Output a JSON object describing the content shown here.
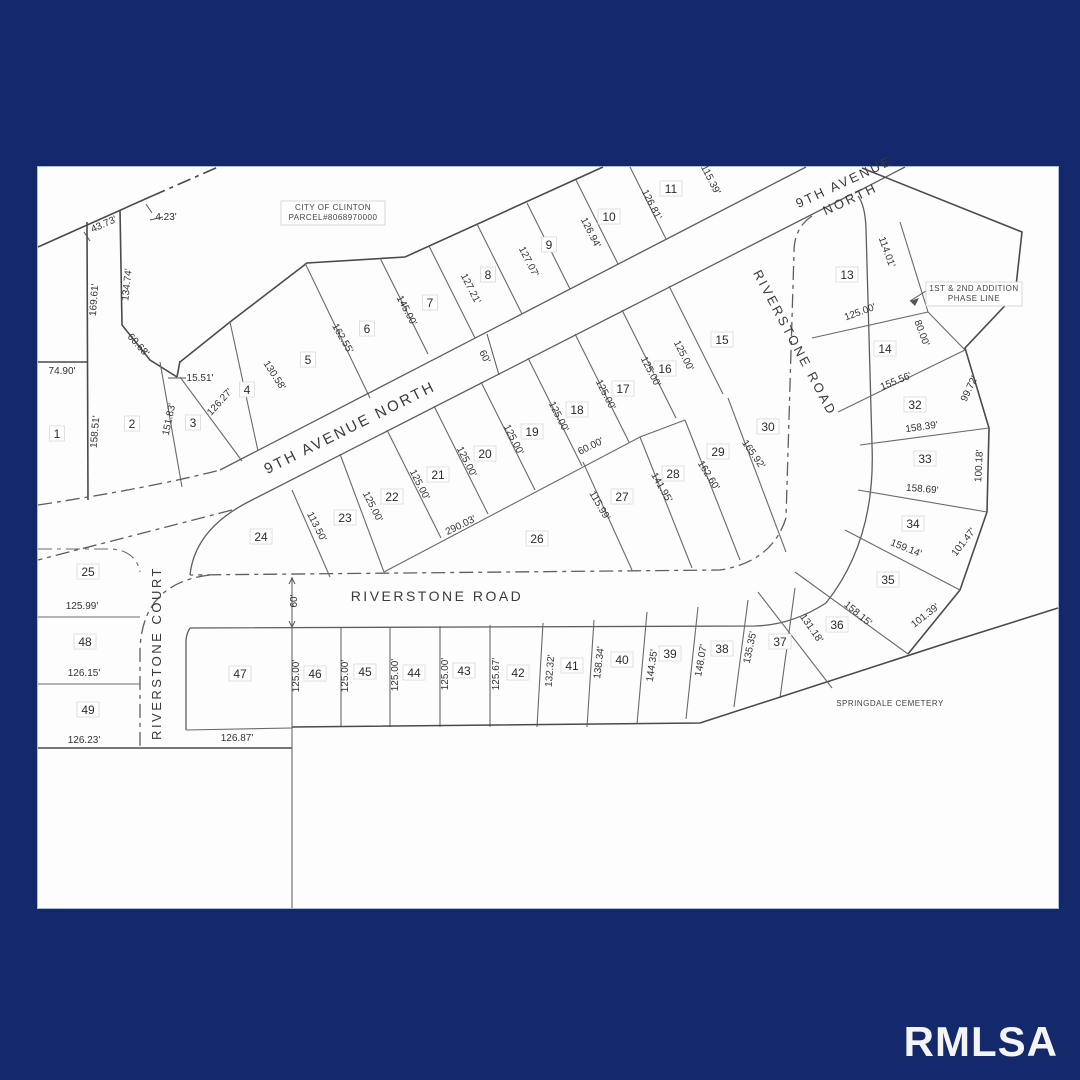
{
  "watermark": "RMLSA",
  "colors": {
    "border_background": "#13296b",
    "paper": "#fdfdfd",
    "line": "#5e5e5e",
    "text": "#2b2b2b"
  },
  "streets": [
    {
      "label": "9TH AVENUE NORTH",
      "x": 352,
      "y": 432,
      "rot": -26.5,
      "size": 15
    },
    {
      "label": "9TH AVENUE",
      "x": 846,
      "y": 186,
      "rot": -25,
      "size": 13
    },
    {
      "label": "NORTH",
      "x": 852,
      "y": 203,
      "rot": -25,
      "size": 13
    },
    {
      "label": "RIVERSTONE ROAD",
      "x": 791,
      "y": 345,
      "rot": 62,
      "size": 13
    },
    {
      "label": "RIVERSTONE ROAD",
      "x": 437,
      "y": 601,
      "rot": 0,
      "size": 14
    },
    {
      "label": "RIVERSTONE COURT",
      "x": 161,
      "y": 653,
      "rot": -90,
      "size": 13
    }
  ],
  "lots": [
    {
      "n": "1",
      "x": 57,
      "y": 437
    },
    {
      "n": "2",
      "x": 132,
      "y": 427
    },
    {
      "n": "3",
      "x": 193,
      "y": 426
    },
    {
      "n": "4",
      "x": 247,
      "y": 393
    },
    {
      "n": "5",
      "x": 308,
      "y": 363
    },
    {
      "n": "6",
      "x": 367,
      "y": 332
    },
    {
      "n": "7",
      "x": 430,
      "y": 306
    },
    {
      "n": "8",
      "x": 488,
      "y": 278
    },
    {
      "n": "9",
      "x": 549,
      "y": 248
    },
    {
      "n": "10",
      "x": 609,
      "y": 220
    },
    {
      "n": "11",
      "x": 671,
      "y": 192
    },
    {
      "n": "13",
      "x": 847,
      "y": 278
    },
    {
      "n": "14",
      "x": 885,
      "y": 352
    },
    {
      "n": "15",
      "x": 722,
      "y": 343
    },
    {
      "n": "16",
      "x": 665,
      "y": 372
    },
    {
      "n": "17",
      "x": 623,
      "y": 392
    },
    {
      "n": "18",
      "x": 577,
      "y": 413
    },
    {
      "n": "19",
      "x": 532,
      "y": 435
    },
    {
      "n": "20",
      "x": 485,
      "y": 457
    },
    {
      "n": "21",
      "x": 438,
      "y": 478
    },
    {
      "n": "22",
      "x": 392,
      "y": 500
    },
    {
      "n": "23",
      "x": 345,
      "y": 521
    },
    {
      "n": "24",
      "x": 261,
      "y": 540
    },
    {
      "n": "25",
      "x": 88,
      "y": 575
    },
    {
      "n": "26",
      "x": 537,
      "y": 542
    },
    {
      "n": "27",
      "x": 622,
      "y": 500
    },
    {
      "n": "28",
      "x": 673,
      "y": 477
    },
    {
      "n": "29",
      "x": 718,
      "y": 455
    },
    {
      "n": "30",
      "x": 768,
      "y": 430
    },
    {
      "n": "32",
      "x": 915,
      "y": 408
    },
    {
      "n": "33",
      "x": 925,
      "y": 462
    },
    {
      "n": "34",
      "x": 913,
      "y": 527
    },
    {
      "n": "35",
      "x": 888,
      "y": 583
    },
    {
      "n": "36",
      "x": 837,
      "y": 628
    },
    {
      "n": "37",
      "x": 780,
      "y": 645
    },
    {
      "n": "38",
      "x": 722,
      "y": 652
    },
    {
      "n": "39",
      "x": 670,
      "y": 657
    },
    {
      "n": "40",
      "x": 622,
      "y": 663
    },
    {
      "n": "41",
      "x": 572,
      "y": 669
    },
    {
      "n": "42",
      "x": 518,
      "y": 676
    },
    {
      "n": "43",
      "x": 464,
      "y": 674
    },
    {
      "n": "44",
      "x": 414,
      "y": 676
    },
    {
      "n": "45",
      "x": 365,
      "y": 675
    },
    {
      "n": "46",
      "x": 315,
      "y": 677
    },
    {
      "n": "47",
      "x": 240,
      "y": 677
    },
    {
      "n": "48",
      "x": 85,
      "y": 645
    },
    {
      "n": "49",
      "x": 88,
      "y": 713
    }
  ],
  "dimensions": [
    {
      "t": "43.73'",
      "x": 105,
      "y": 227,
      "r": -24
    },
    {
      "t": "4.23'",
      "x": 166,
      "y": 220,
      "r": 0
    },
    {
      "t": "134.74'",
      "x": 130,
      "y": 285,
      "r": -84
    },
    {
      "t": "169.61'",
      "x": 97,
      "y": 300,
      "r": -86
    },
    {
      "t": "74.90'",
      "x": 62,
      "y": 374,
      "r": 0
    },
    {
      "t": "60.68'",
      "x": 136,
      "y": 347,
      "r": 48
    },
    {
      "t": "15.51'",
      "x": 200,
      "y": 381,
      "r": 0
    },
    {
      "t": "158.51'",
      "x": 98,
      "y": 432,
      "r": -85
    },
    {
      "t": "151.83'",
      "x": 172,
      "y": 420,
      "r": -78
    },
    {
      "t": "126.27'",
      "x": 222,
      "y": 404,
      "r": -48
    },
    {
      "t": "130.58'",
      "x": 272,
      "y": 377,
      "r": 57
    },
    {
      "t": "162.55'",
      "x": 340,
      "y": 340,
      "r": 60
    },
    {
      "t": "145.00'",
      "x": 404,
      "y": 312,
      "r": 62
    },
    {
      "t": "127.21'",
      "x": 468,
      "y": 290,
      "r": 63
    },
    {
      "t": "127.07'",
      "x": 526,
      "y": 263,
      "r": 63
    },
    {
      "t": "126.94'",
      "x": 588,
      "y": 234,
      "r": 63
    },
    {
      "t": "126.81'",
      "x": 649,
      "y": 206,
      "r": 63
    },
    {
      "t": "115.39'",
      "x": 708,
      "y": 181,
      "r": 63
    },
    {
      "t": "60'",
      "x": 482,
      "y": 358,
      "r": 63
    },
    {
      "t": "114.01'",
      "x": 884,
      "y": 253,
      "r": 70
    },
    {
      "t": "125.00'",
      "x": 861,
      "y": 315,
      "r": -20
    },
    {
      "t": "80.00'",
      "x": 919,
      "y": 334,
      "r": 70
    },
    {
      "t": "155.56'",
      "x": 897,
      "y": 384,
      "r": -22
    },
    {
      "t": "99.72'",
      "x": 972,
      "y": 390,
      "r": -65
    },
    {
      "t": "158.39'",
      "x": 922,
      "y": 430,
      "r": -8
    },
    {
      "t": "100.18'",
      "x": 982,
      "y": 466,
      "r": -87
    },
    {
      "t": "158.69'",
      "x": 922,
      "y": 492,
      "r": 5
    },
    {
      "t": "159.14'",
      "x": 905,
      "y": 551,
      "r": 22
    },
    {
      "t": "101.47'",
      "x": 966,
      "y": 544,
      "r": -52
    },
    {
      "t": "158.15'",
      "x": 856,
      "y": 616,
      "r": 40
    },
    {
      "t": "101.39'",
      "x": 927,
      "y": 618,
      "r": -38
    },
    {
      "t": "131.18'",
      "x": 809,
      "y": 630,
      "r": 55
    },
    {
      "t": "113.50'",
      "x": 314,
      "y": 528,
      "r": 63
    },
    {
      "t": "125.00'",
      "x": 370,
      "y": 508,
      "r": 63
    },
    {
      "t": "125.00'",
      "x": 417,
      "y": 486,
      "r": 63
    },
    {
      "t": "125.00'",
      "x": 464,
      "y": 463,
      "r": 63
    },
    {
      "t": "125.00'",
      "x": 511,
      "y": 441,
      "r": 63
    },
    {
      "t": "125.00'",
      "x": 556,
      "y": 418,
      "r": 63
    },
    {
      "t": "125.00'",
      "x": 603,
      "y": 396,
      "r": 63
    },
    {
      "t": "125.00'",
      "x": 648,
      "y": 373,
      "r": 63
    },
    {
      "t": "125.00'",
      "x": 681,
      "y": 357,
      "r": 63
    },
    {
      "t": "290.03'",
      "x": 462,
      "y": 528,
      "r": -26
    },
    {
      "t": "60.00'",
      "x": 592,
      "y": 449,
      "r": -26
    },
    {
      "t": "115.99'",
      "x": 597,
      "y": 507,
      "r": 60
    },
    {
      "t": "141.95'",
      "x": 659,
      "y": 489,
      "r": 60
    },
    {
      "t": "162.60'",
      "x": 706,
      "y": 477,
      "r": 58
    },
    {
      "t": "165.92'",
      "x": 751,
      "y": 456,
      "r": 55
    },
    {
      "t": "125.99'",
      "x": 82,
      "y": 609,
      "r": 0
    },
    {
      "t": "126.15'",
      "x": 84,
      "y": 676,
      "r": 0
    },
    {
      "t": "126.23'",
      "x": 84,
      "y": 743,
      "r": 0
    },
    {
      "t": "126.87'",
      "x": 237,
      "y": 741,
      "r": 0
    },
    {
      "t": "60'",
      "x": 297,
      "y": 601,
      "r": -90
    },
    {
      "t": "125.00'",
      "x": 299,
      "y": 676,
      "r": -90
    },
    {
      "t": "125.00'",
      "x": 348,
      "y": 676,
      "r": -90
    },
    {
      "t": "125.00'",
      "x": 398,
      "y": 675,
      "r": -90
    },
    {
      "t": "125.00'",
      "x": 448,
      "y": 674,
      "r": -90
    },
    {
      "t": "125.67'",
      "x": 499,
      "y": 674,
      "r": -90
    },
    {
      "t": "132.32'",
      "x": 553,
      "y": 671,
      "r": -85
    },
    {
      "t": "138.34'",
      "x": 602,
      "y": 663,
      "r": -83
    },
    {
      "t": "144.35'",
      "x": 655,
      "y": 666,
      "r": -82
    },
    {
      "t": "148.07'",
      "x": 704,
      "y": 661,
      "r": -80
    },
    {
      "t": "135.35'",
      "x": 753,
      "y": 648,
      "r": -78
    }
  ],
  "notes": [
    {
      "lines": [
        "CITY  OF  CLINTON",
        "PARCEL#8068970000"
      ],
      "x": 333,
      "y": 210,
      "boxed": true,
      "w": 104,
      "h": 24
    },
    {
      "lines": [
        "1ST  &  2ND  ADDITION",
        "PHASE  LINE"
      ],
      "x": 974,
      "y": 291,
      "boxed": true,
      "w": 96,
      "h": 24,
      "align": "left"
    },
    {
      "lines": [
        "SPRINGDALE  CEMETERY"
      ],
      "x": 890,
      "y": 706,
      "boxed": false,
      "w": 110,
      "h": 14
    }
  ]
}
